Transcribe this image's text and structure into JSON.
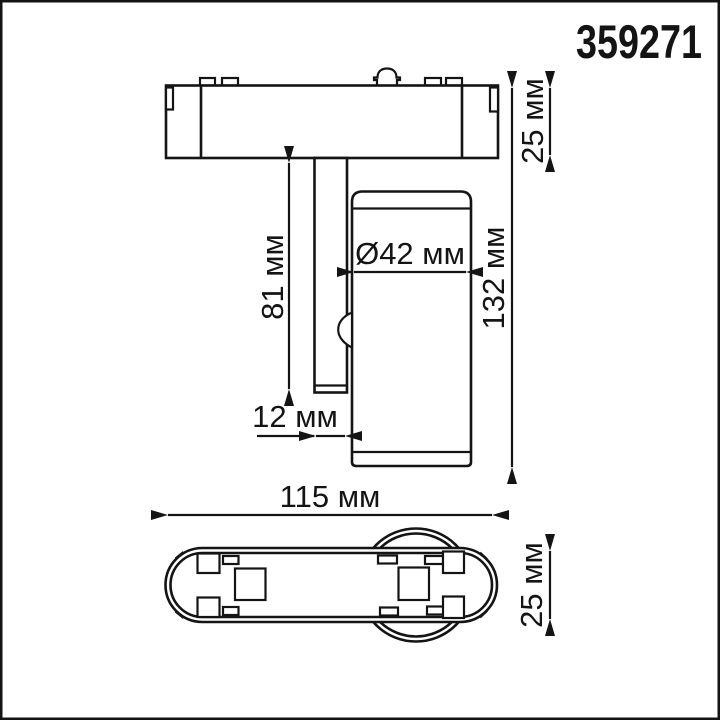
{
  "product": {
    "code": "359271"
  },
  "colors": {
    "line": "#141414",
    "background": "#ffffff"
  },
  "drawing": {
    "kind": "technical-dimension-drawing",
    "unit": "мм",
    "views": {
      "front": {
        "title": "front view",
        "dimensions": {
          "track_height": {
            "label": "25 мм",
            "value_mm": 25
          },
          "stem_length": {
            "label": "81 мм",
            "value_mm": 81
          },
          "head_diameter": {
            "label": "Ø42 мм",
            "value_mm": 42
          },
          "total_height": {
            "label": "132 мм",
            "value_mm": 132
          },
          "stem_width": {
            "label": "12 мм",
            "value_mm": 12
          }
        }
      },
      "bottom": {
        "title": "bottom view",
        "dimensions": {
          "base_length": {
            "label": "115 мм",
            "value_mm": 115
          },
          "base_width": {
            "label": "25 мм",
            "value_mm": 25
          }
        }
      }
    }
  }
}
